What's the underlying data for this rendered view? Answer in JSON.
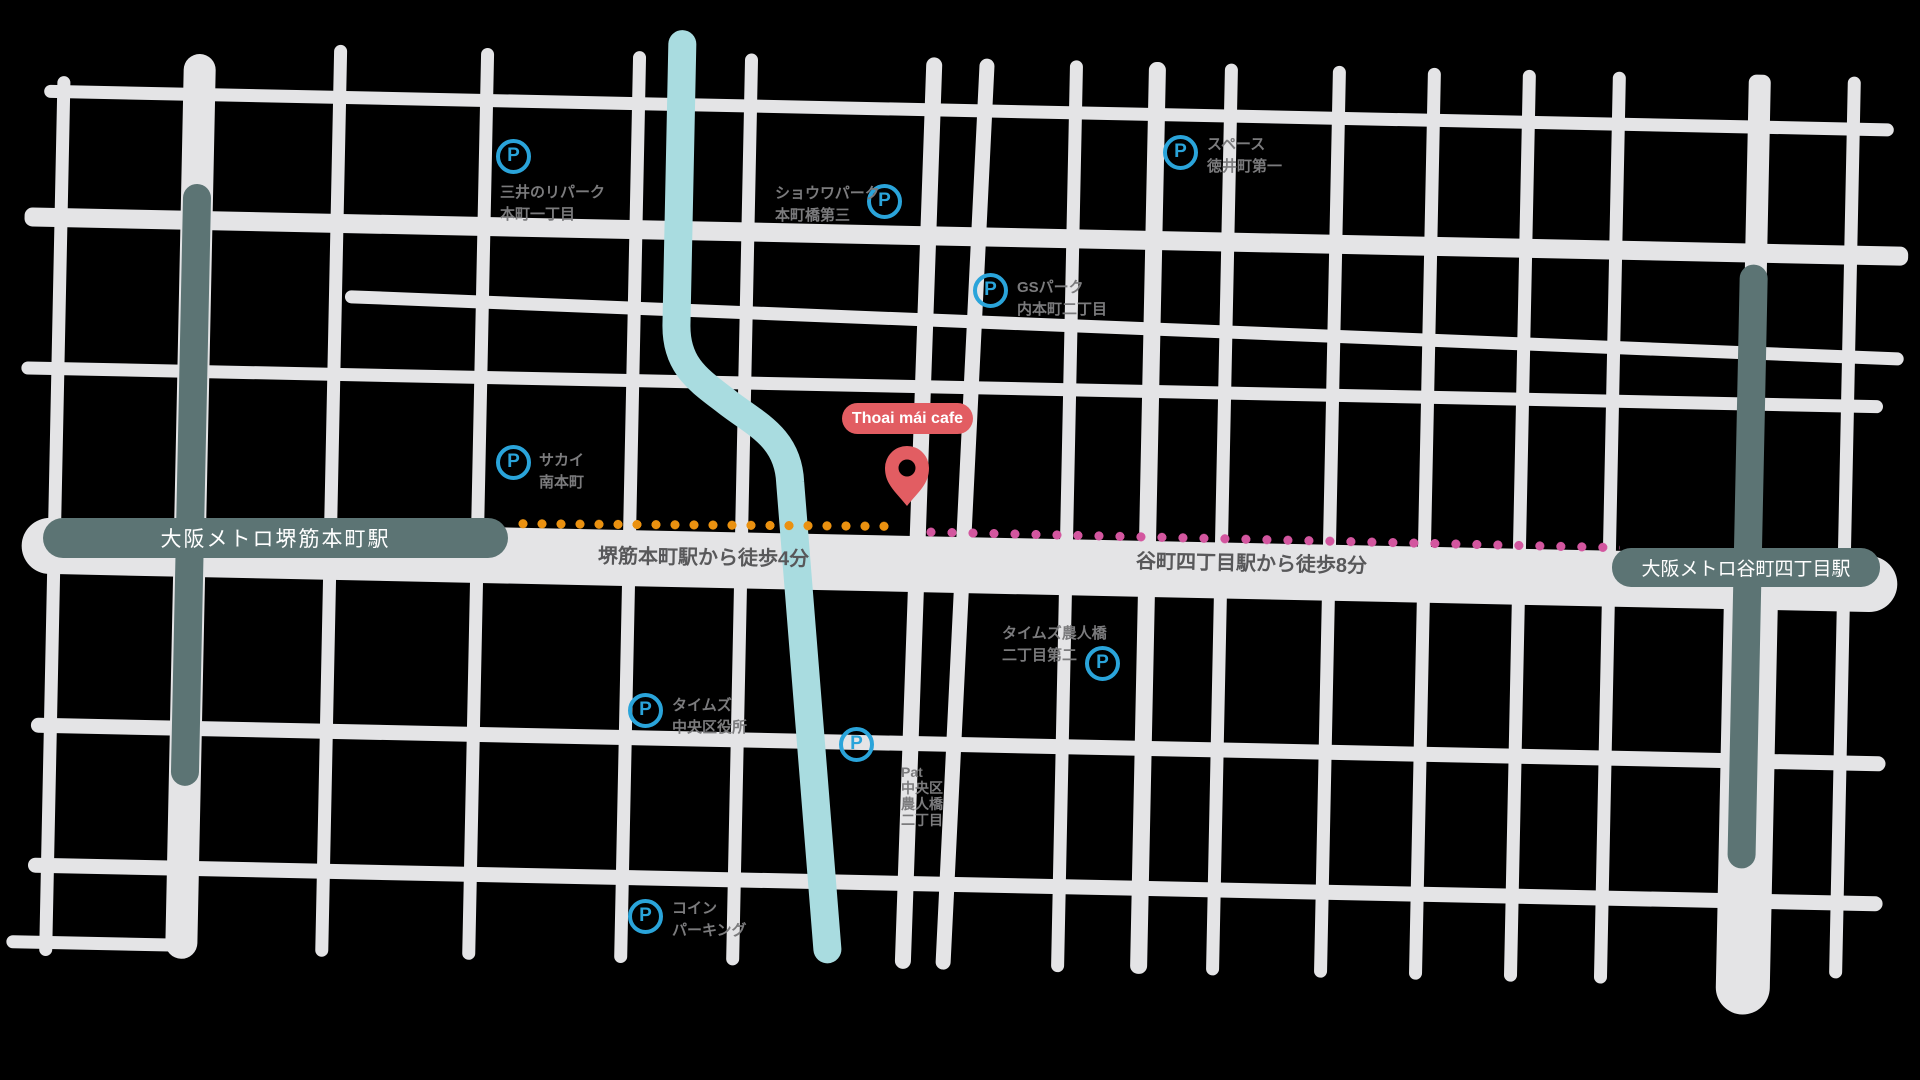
{
  "map": {
    "background_color": "#000000",
    "road_color": "#e4e4e6",
    "river_color": "#a9dce0",
    "subway_line_color": "#5c7474",
    "parking_icon_color": "#2aa4da",
    "cafe_accent_color": "#e25d62",
    "label_color": "#7b7b7d",
    "cafe": {
      "name": "Thoai mái cafe"
    },
    "stations": [
      {
        "name": "大阪メトロ堺筋本町駅"
      },
      {
        "name": "大阪メトロ谷町四丁目駅"
      }
    ],
    "routes": [
      {
        "label": "堺筋本町駅から徒歩4分",
        "dot_color": "#ea9110"
      },
      {
        "label": "谷町四丁目駅から徒歩8分",
        "dot_color": "#d3569f"
      }
    ],
    "parkings": [
      {
        "icon": "P",
        "lines": [
          "三井のリパーク",
          "本町一丁目"
        ]
      },
      {
        "icon": "P",
        "lines": [
          "ショウワパーク",
          "本町橋第三"
        ]
      },
      {
        "icon": "P",
        "lines": [
          "スペース",
          "徳井町第一"
        ]
      },
      {
        "icon": "P",
        "lines": [
          "GSパーク",
          "内本町二丁目"
        ]
      },
      {
        "icon": "P",
        "lines": [
          "サカイ",
          "南本町"
        ]
      },
      {
        "icon": "P",
        "lines": [
          "タイムズ農人橋",
          "二丁目第二"
        ]
      },
      {
        "icon": "P",
        "lines": [
          "タイムズ",
          "中央区役所"
        ]
      },
      {
        "icon": "P",
        "lines": [
          "Pat",
          "中央区",
          "農人橋",
          "二丁目"
        ]
      },
      {
        "icon": "P",
        "lines": [
          "コイン",
          "パーキング"
        ]
      }
    ]
  }
}
